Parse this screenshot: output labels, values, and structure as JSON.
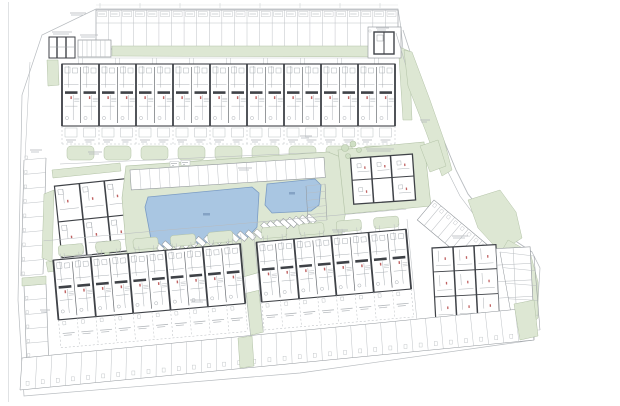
{
  "document": {
    "kind_label": ""
  },
  "colors": {
    "paper": "#ffffff",
    "line_light": "#b7bbbf",
    "line_mid": "#8e9398",
    "wall": "#3f4247",
    "wall_soft": "#6a6e73",
    "green": "#dde7d3",
    "green_edge": "#b2c2a6",
    "green_dark": "#cfdfc4",
    "pool": "#a9c6e2",
    "pool_edge": "#7b9cc4",
    "pool_text": "#84a2c4",
    "red": "#c06262",
    "detail": "#9aa0a6",
    "micro": "#b4b8bc"
  },
  "site_plan": {
    "top_allotments": {
      "plots": 24
    },
    "top_terrace_row": {
      "pairs": 9
    },
    "left_parking": {
      "upper_stalls": 8,
      "lower_stalls": 6
    },
    "central_parking": {
      "stalls": 20
    },
    "pools": {
      "count": 2
    },
    "loungers": {
      "row_a": 13,
      "row_b": 8
    },
    "pool_side_stalls": {
      "stalls": 5
    },
    "angled_parking": {
      "stalls": 8
    },
    "east_plots_column": {
      "plots": 5
    },
    "bottom_terraces_west": {
      "pairs": 5
    },
    "bottom_terraces_mid": {
      "pairs": 4
    },
    "east_apartment_grid": {
      "cols": 2,
      "rows": 4
    },
    "bottom_plots_row": {
      "plots": 34
    },
    "apartment_blocks": {
      "count": 3
    }
  }
}
